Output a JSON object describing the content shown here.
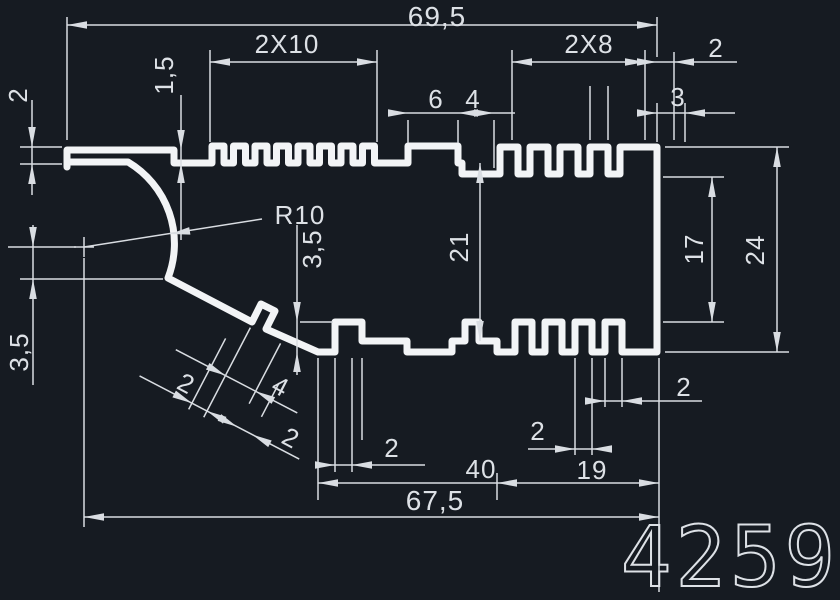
{
  "drawing": {
    "part_number": "4259",
    "colors": {
      "background": "#161b22",
      "profile_line": "#f2f4f6",
      "dimension_line": "#d9dde2",
      "text": "#dde1e6"
    },
    "dimensions": {
      "overall_width_top": "69,5",
      "teeth_group_left": "2X10",
      "teeth_group_right": "2X8",
      "wall_top_right": "2",
      "left_cap_thickness": "2",
      "step_height": "1,5",
      "bump_width": "6",
      "notch_width": "4",
      "right_end_flat": "3",
      "fillet_radius": "R10",
      "left_offset_height": "3,5",
      "tab_drop_height": "3,5",
      "inner_height": "21",
      "right_inner_height": "17",
      "overall_height_right": "24",
      "diag_wall_a": "2",
      "diag_tab_width": "4",
      "diag_wall_b": "2",
      "bottom_tooth_mid": "2",
      "bottom_tooth_right_low": "2",
      "bottom_tooth_right_up": "2",
      "bottom_span_40": "40",
      "bottom_span_19": "19",
      "overall_width_bottom": "67,5"
    }
  }
}
